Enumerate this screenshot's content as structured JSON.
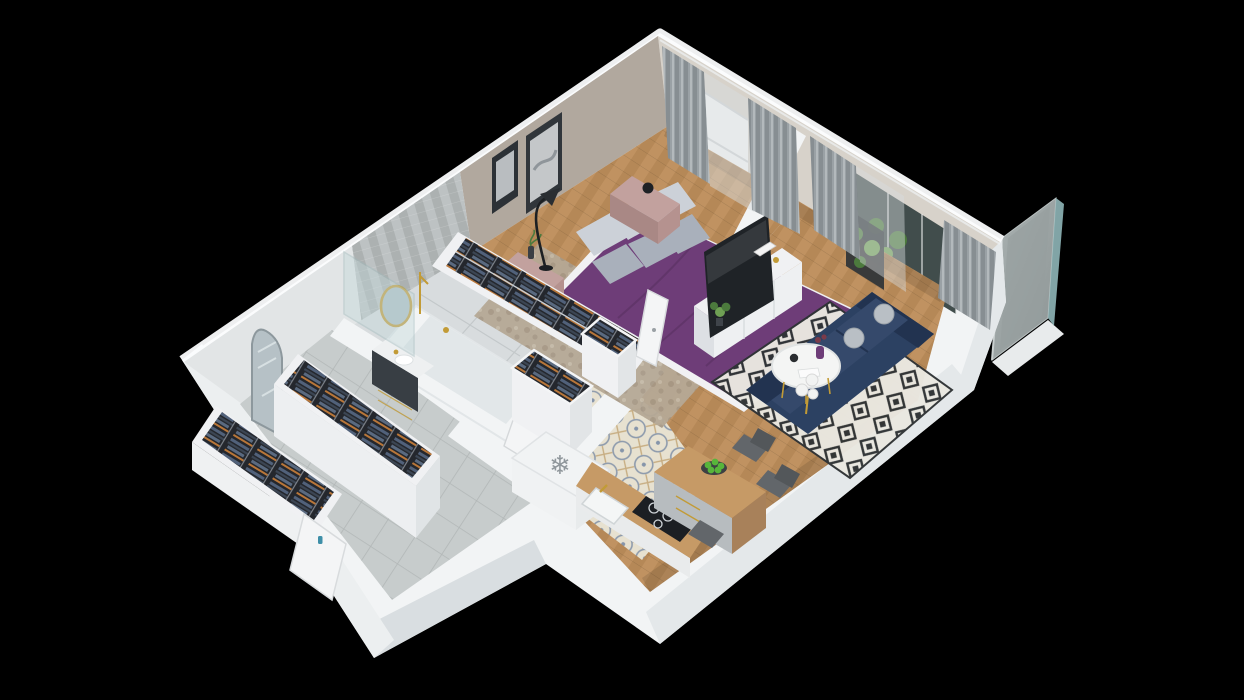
{
  "scene": {
    "title": "3D isometric apartment floor-plan render",
    "style": "dollhouse cutaway seen from above on black background",
    "background": "#000000"
  },
  "palette": {
    "wall_face": "#f2f4f5",
    "wall_shade": "#e4e8ea",
    "wall_shade_dark": "#d9dee1",
    "wall_top": "#fbfcfd",
    "wall_inner_ne": "#d7d2ca",
    "bedroom_wall": "#b1a89e",
    "corridor_wall": "#e2e5e6",
    "bath_wall": "#a9aeae",
    "bath_wall_light": "#bdc2c3",
    "floor_wood": "#c09261",
    "floor_wood_dark": "#a87c4c",
    "bedroom_rug": "#b5a895",
    "bedroom_rug_spot": "#978876",
    "bath_floor": "#d8dcde",
    "corridor_tile": "#c7cccc",
    "corridor_grout": "#b2b7b7",
    "kitchen_tile_bg": "#e7e1d0",
    "kitchen_tile_blue": "#6e82a0",
    "kitchen_tile_tan": "#bfa06e",
    "rug_bg": "#eae8e1",
    "rug_ink": "#2f3335",
    "bed_purple": "#6e3d78",
    "bed_purple_deep": "#57305f",
    "blanket_white": "#f1f1f3",
    "pillow_light": "#ccd1d8",
    "pillow_dark": "#a9b0bb",
    "nightstand_pink": "#c2a19e",
    "nightstand_pink_dark": "#a98885",
    "sofa_navy": "#2c4162",
    "sofa_navy_deep": "#223350",
    "sofa_cushion": "#35496b",
    "pillow_ball": "#b9bfc5",
    "tv_black": "#1f2327",
    "sideboard_white": "#f0f1f3",
    "sideboard_shade": "#dde0e4",
    "wardrobe_dark": "#24272d",
    "clothes_blue": "#51617a",
    "clothes_steel": "#3c4654",
    "clothes_orange": "#c07a3a",
    "gold": "#c29b36",
    "plant_green": "#4c7a3d",
    "plant_green_light": "#6fa054",
    "apple_green": "#57b53b",
    "glass_teal": "#8fb6b8",
    "panel_gray": "#9aa2a2",
    "curtain_dark": "#878e92",
    "curtain_mid": "#9aa1a5",
    "curtain_sheer": "#d8dcde",
    "window_glow": "#f7f9f9",
    "glass_dark": "#414d4c",
    "door_white": "#f4f5f6",
    "counter_wood": "#c69a66",
    "cabinet_gray": "#b7bcbf",
    "vanity_dark": "#383e44",
    "vanity_top": "#eef0f1",
    "mirror_glass": "#adbfc4",
    "chair_gray": "#62666a",
    "handle_teal": "#3e8fa8",
    "fridge_white": "#f1f3f4",
    "snowflake_gray": "#8f969b",
    "tub_white": "#f2f4f5",
    "tub_inner": "#e2e7e9",
    "shower_glass": "#c3d8da"
  },
  "icons": {
    "snowflake": {
      "name": "snowflake-icon",
      "glyph": "❄",
      "meaning": "refrigerator marker on fridge top"
    }
  },
  "rooms": [
    {
      "name": "bedroom",
      "furniture": [
        "double bed with purple duvet",
        "gray pillows",
        "two pink nightstands",
        "black alarm clock",
        "two framed wall artworks",
        "black arc floor lamp",
        "open wardrobe full of hanging clothes",
        "window with gray curtains",
        "mottled beige area rug",
        "white door to hallway"
      ]
    },
    {
      "name": "living-room",
      "furniture": [
        "white TV sideboard",
        "flat-screen TV",
        "black-and-white diamond rug",
        "navy blue sofa with round gray cushions",
        "round white coffee table with purple vase",
        "white sphere floor lamp",
        "black plant shelf",
        "glass balcony door with gray curtains"
      ]
    },
    {
      "name": "kitchen-dining",
      "furniture": [
        "refrigerator with snowflake marker",
        "wooden worktop with black induction hob",
        "white sink with gold faucet",
        "L-shaped wooden dining counter",
        "bowl of green apples",
        "three gray chairs",
        "patterned encaustic tile floor"
      ]
    },
    {
      "name": "bathroom",
      "furniture": [
        "white bathtub with gold fixtures",
        "dark vanity with white basin",
        "round gold-framed mirror",
        "glass shower screen",
        "herringbone tiled wall"
      ]
    },
    {
      "name": "hallway",
      "furniture": [
        "two open wardrobe cabinets with clothes",
        "patterned tile floor",
        "doors to bedroom and bathroom"
      ]
    },
    {
      "name": "entry-corridor",
      "furniture": [
        "two long open wardrobes with hanging clothes",
        "arched standing mirror",
        "gray tile floor",
        "entry door with teal handle"
      ]
    },
    {
      "name": "balcony",
      "furniture": [
        "gray privacy panel with teal glass edge",
        "narrow balcony deck"
      ]
    }
  ]
}
